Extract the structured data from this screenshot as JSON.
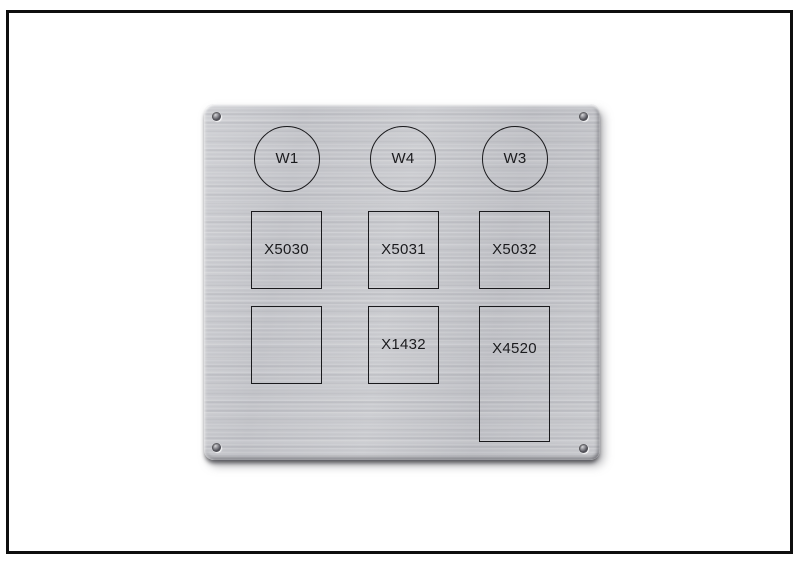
{
  "colors": {
    "background": "#ffffff",
    "frame_border": "#0e0e0e",
    "plate_metal": "#c6c7cb",
    "engraving_line": "#1a1a1d",
    "engraving_text": "#1b1b1e"
  },
  "plate": {
    "circle_labels": [
      "W1",
      "W4",
      "W3"
    ],
    "row1_labels": [
      "X5030",
      "X5031",
      "X5032"
    ],
    "row2_labels": [
      "",
      "X1432",
      "X4520"
    ]
  }
}
